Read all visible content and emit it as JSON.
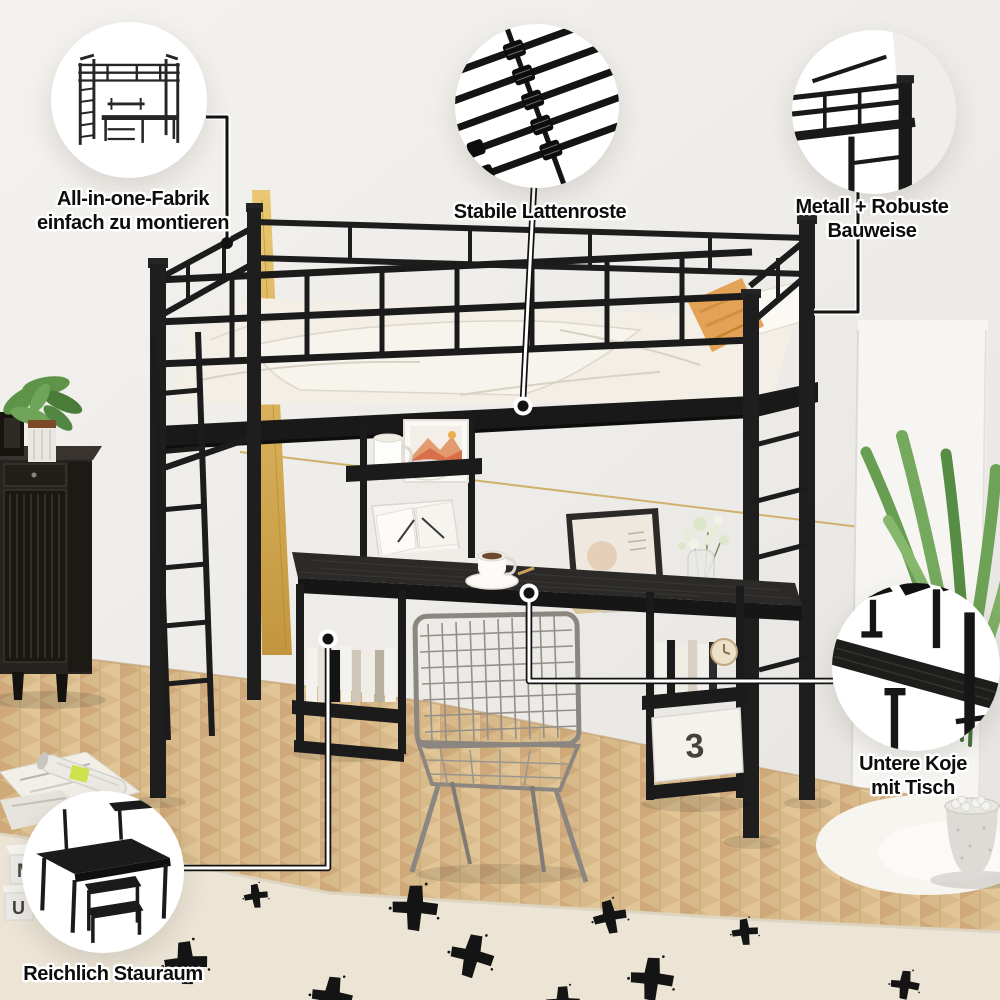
{
  "image": {
    "description": "Loft bed with under-bed desk and shelves, product photo annotated with five feature callouts",
    "language": "de"
  },
  "callouts": [
    {
      "id": "assembly",
      "icon": "loft-bed-line-art-icon",
      "lines": [
        "All-in-one-Fabrik",
        "einfach zu montieren"
      ]
    },
    {
      "id": "slats",
      "icon": "metal-slats-photo-icon",
      "lines": [
        "Stabile Lattenroste"
      ]
    },
    {
      "id": "metal-build",
      "icon": "metal-frame-corner-photo-icon",
      "lines": [
        "Metall + Robuste",
        "Bauweise"
      ]
    },
    {
      "id": "lower-desk",
      "icon": "under-bed-desk-photo-icon",
      "lines": [
        "Untere Koje",
        "mit Tisch"
      ]
    },
    {
      "id": "storage",
      "icon": "storage-shelf-line-art-icon",
      "lines": [
        "Reichlich Stauraum"
      ]
    }
  ],
  "decor": {
    "letter_blocks": [
      "M",
      "U"
    ],
    "storage_box_label": "3"
  },
  "colors": {
    "bed_frame_black": "#1c1c1c",
    "accent_gold_stripe": "#ddb15e",
    "pillow_orange": "#e2a157",
    "wall": "#efede9",
    "floor_wood": "#d8ba8a",
    "rug_cream": "#ece5d6",
    "rug_pattern_black": "#141414",
    "desk_wood_black": "#2b2a28",
    "plant_green": "#6aa055",
    "label_text": "#0d0d0d",
    "label_outline": "#ffffff"
  }
}
